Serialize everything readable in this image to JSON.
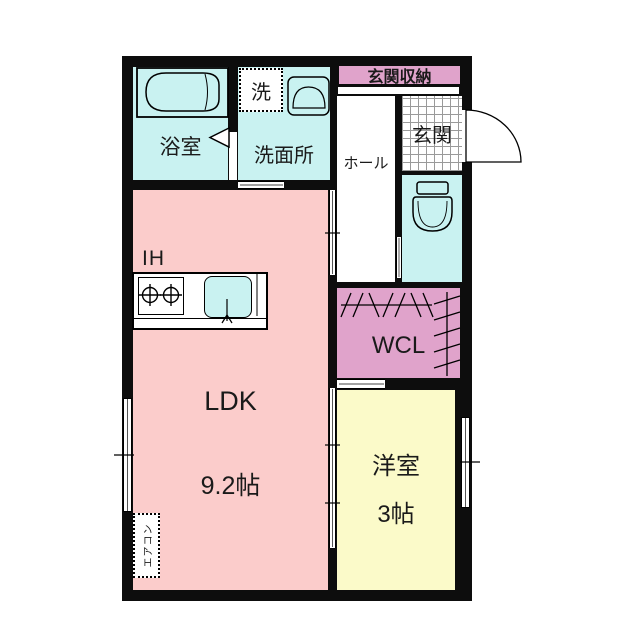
{
  "plan": {
    "rooms": {
      "ldk": {
        "name": "LDK",
        "area": "9.2帖"
      },
      "western_room": {
        "name": "洋室",
        "area": "3帖"
      },
      "bathroom": {
        "name": "浴室"
      },
      "washroom": {
        "name": "洗面所"
      },
      "hall": {
        "name": "ホール"
      },
      "entrance": {
        "name": "玄関"
      },
      "entrance_storage": {
        "name": "玄関収納"
      },
      "walk_in_closet": {
        "name": "WCL"
      }
    },
    "fixtures": {
      "washing_machine": "洗",
      "ih_cooktop": "IH",
      "air_conditioner": "エアコン"
    },
    "colors": {
      "ldk_pink": "#fbcccb",
      "wet_area_cyan": "#c9f2f1",
      "western_room_yellow": "#fbfac9",
      "closet_mauve": "#e0a3cb",
      "wall_black": "#0d0d0d"
    }
  }
}
